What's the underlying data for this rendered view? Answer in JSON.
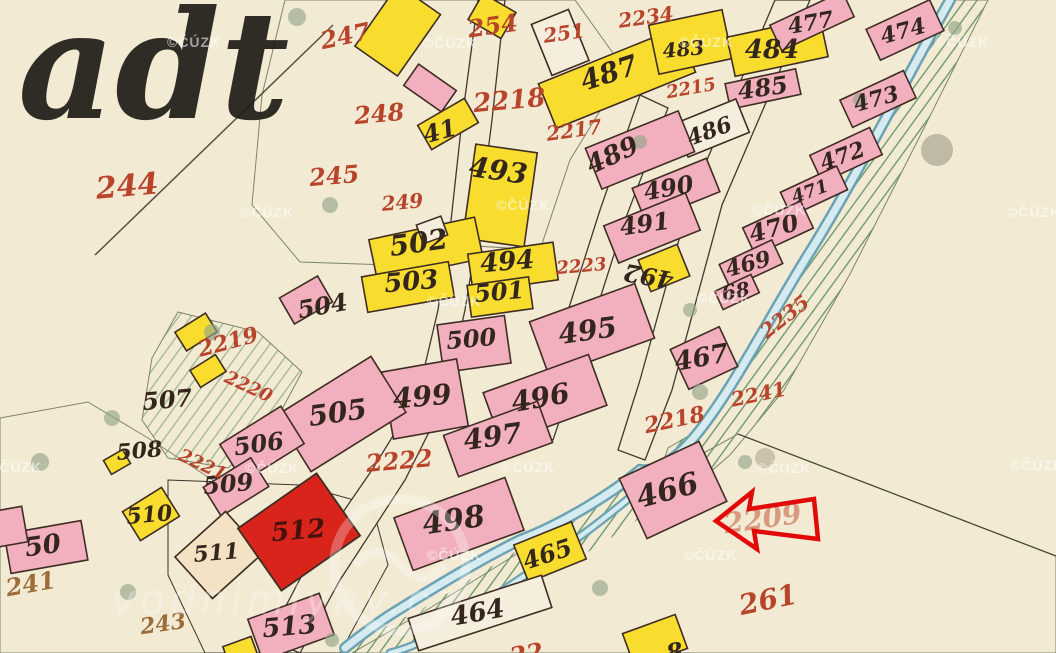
{
  "map": {
    "title_fragment": "adt",
    "copyright": "©ČÚZK",
    "watermark_logo": "vodnimlyny.cz",
    "arrow": {
      "color": "#e20909",
      "points_to_parcel": "466"
    },
    "colors": {
      "paper": "#f3ead3",
      "green_land": "#b3d5a8",
      "building_pink": "#f2afbe",
      "building_yellow": "#f8dd2f",
      "building_red": "#d9241b",
      "stream_blue": "#6ba3b5",
      "black_ink": "#33261c",
      "red_ink": "#b8442b"
    },
    "labels": [
      {
        "t": "41",
        "x": 442,
        "y": 139,
        "s": 24,
        "c": "ink",
        "r": -15
      },
      {
        "t": "483",
        "x": 684,
        "y": 56,
        "s": 20,
        "c": "ink",
        "r": -5
      },
      {
        "t": "484",
        "x": 772,
        "y": 58,
        "s": 26,
        "c": "ink",
        "r": 0
      },
      {
        "t": "485",
        "x": 764,
        "y": 96,
        "s": 24,
        "c": "ink",
        "r": -8
      },
      {
        "t": "477",
        "x": 812,
        "y": 30,
        "s": 22,
        "c": "ink",
        "r": -10
      },
      {
        "t": "474",
        "x": 905,
        "y": 38,
        "s": 22,
        "c": "ink",
        "r": -15
      },
      {
        "t": "473",
        "x": 878,
        "y": 106,
        "s": 22,
        "c": "ink",
        "r": -15
      },
      {
        "t": "472",
        "x": 845,
        "y": 163,
        "s": 22,
        "c": "ink",
        "r": -20
      },
      {
        "t": "471",
        "x": 812,
        "y": 197,
        "s": 18,
        "c": "ink",
        "r": -20
      },
      {
        "t": "470",
        "x": 776,
        "y": 236,
        "s": 24,
        "c": "ink",
        "r": -15
      },
      {
        "t": "469",
        "x": 750,
        "y": 271,
        "s": 22,
        "c": "ink",
        "r": -15
      },
      {
        "t": "68",
        "x": 737,
        "y": 298,
        "s": 20,
        "c": "ink",
        "r": -10
      },
      {
        "t": "467",
        "x": 703,
        "y": 366,
        "s": 26,
        "c": "ink",
        "r": -10
      },
      {
        "t": "466",
        "x": 670,
        "y": 500,
        "s": 30,
        "c": "ink",
        "r": -15
      },
      {
        "t": "486",
        "x": 712,
        "y": 138,
        "s": 22,
        "c": "ink",
        "r": -20
      },
      {
        "t": "487",
        "x": 612,
        "y": 82,
        "s": 28,
        "c": "ink",
        "r": -18
      },
      {
        "t": "489",
        "x": 616,
        "y": 163,
        "s": 26,
        "c": "ink",
        "r": -25
      },
      {
        "t": "490",
        "x": 670,
        "y": 196,
        "s": 24,
        "c": "ink",
        "r": -10
      },
      {
        "t": "491",
        "x": 646,
        "y": 232,
        "s": 24,
        "c": "ink",
        "r": -8
      },
      {
        "t": "492",
        "x": 650,
        "y": 268,
        "s": 24,
        "c": "ink",
        "r": 190
      },
      {
        "t": "493",
        "x": 497,
        "y": 180,
        "s": 28,
        "c": "ink",
        "r": 8
      },
      {
        "t": "494",
        "x": 508,
        "y": 270,
        "s": 26,
        "c": "ink",
        "r": -5
      },
      {
        "t": "501",
        "x": 500,
        "y": 300,
        "s": 24,
        "c": "ink",
        "r": -5
      },
      {
        "t": "502",
        "x": 420,
        "y": 252,
        "s": 28,
        "c": "ink",
        "r": -8
      },
      {
        "t": "503",
        "x": 412,
        "y": 290,
        "s": 26,
        "c": "ink",
        "r": -5
      },
      {
        "t": "500",
        "x": 472,
        "y": 347,
        "s": 24,
        "c": "ink",
        "r": -5
      },
      {
        "t": "495",
        "x": 589,
        "y": 340,
        "s": 28,
        "c": "ink",
        "r": -8
      },
      {
        "t": "496",
        "x": 542,
        "y": 407,
        "s": 28,
        "c": "ink",
        "r": -10
      },
      {
        "t": "497",
        "x": 494,
        "y": 446,
        "s": 28,
        "c": "ink",
        "r": -8
      },
      {
        "t": "498",
        "x": 455,
        "y": 530,
        "s": 30,
        "c": "ink",
        "r": -8
      },
      {
        "t": "499",
        "x": 423,
        "y": 406,
        "s": 28,
        "c": "ink",
        "r": -5
      },
      {
        "t": "504",
        "x": 324,
        "y": 314,
        "s": 24,
        "c": "ink",
        "r": -10
      },
      {
        "t": "505",
        "x": 339,
        "y": 422,
        "s": 28,
        "c": "ink",
        "r": -8
      },
      {
        "t": "506",
        "x": 260,
        "y": 452,
        "s": 24,
        "c": "ink",
        "r": -8
      },
      {
        "t": "507",
        "x": 168,
        "y": 408,
        "s": 24,
        "c": "ink",
        "r": -5
      },
      {
        "t": "508",
        "x": 140,
        "y": 458,
        "s": 22,
        "c": "ink",
        "r": -5
      },
      {
        "t": "509",
        "x": 229,
        "y": 492,
        "s": 24,
        "c": "ink",
        "r": -5
      },
      {
        "t": "510",
        "x": 150,
        "y": 522,
        "s": 22,
        "c": "ink",
        "r": -5
      },
      {
        "t": "511",
        "x": 217,
        "y": 560,
        "s": 22,
        "c": "ink",
        "r": -5
      },
      {
        "t": "512",
        "x": 299,
        "y": 539,
        "s": 26,
        "c": "dark",
        "r": -5
      },
      {
        "t": "513",
        "x": 290,
        "y": 635,
        "s": 26,
        "c": "ink",
        "r": -5
      },
      {
        "t": "50",
        "x": 44,
        "y": 554,
        "s": 26,
        "c": "ink",
        "r": -8
      },
      {
        "t": "464",
        "x": 479,
        "y": 621,
        "s": 26,
        "c": "ink",
        "r": -10
      },
      {
        "t": "465",
        "x": 550,
        "y": 562,
        "s": 24,
        "c": "ink",
        "r": -18
      },
      {
        "t": "8",
        "x": 676,
        "y": 660,
        "s": 24,
        "c": "ink",
        "r": -10
      },
      {
        "t": "244",
        "x": 128,
        "y": 196,
        "s": 30,
        "c": "red",
        "r": -5
      },
      {
        "t": "247",
        "x": 347,
        "y": 44,
        "s": 24,
        "c": "red",
        "r": -12
      },
      {
        "t": "248",
        "x": 380,
        "y": 122,
        "s": 24,
        "c": "red",
        "r": -5
      },
      {
        "t": "245",
        "x": 335,
        "y": 184,
        "s": 24,
        "c": "red",
        "r": -5
      },
      {
        "t": "249",
        "x": 403,
        "y": 209,
        "s": 20,
        "c": "red",
        "r": -5
      },
      {
        "t": "254",
        "x": 494,
        "y": 34,
        "s": 24,
        "c": "red",
        "r": -8
      },
      {
        "t": "251",
        "x": 565,
        "y": 40,
        "s": 20,
        "c": "red",
        "r": -8
      },
      {
        "t": "2234",
        "x": 647,
        "y": 24,
        "s": 20,
        "c": "red",
        "r": -8
      },
      {
        "t": "2215",
        "x": 692,
        "y": 94,
        "s": 18,
        "c": "red",
        "r": -10
      },
      {
        "t": "2218",
        "x": 510,
        "y": 109,
        "s": 26,
        "c": "red",
        "r": -5
      },
      {
        "t": "2217",
        "x": 575,
        "y": 137,
        "s": 20,
        "c": "red",
        "r": -8
      },
      {
        "t": "2223",
        "x": 582,
        "y": 272,
        "s": 18,
        "c": "red",
        "r": -5
      },
      {
        "t": "2219",
        "x": 230,
        "y": 349,
        "s": 22,
        "c": "red",
        "r": -15
      },
      {
        "t": "2220",
        "x": 246,
        "y": 392,
        "s": 18,
        "c": "red",
        "r": 25
      },
      {
        "t": "2221",
        "x": 200,
        "y": 470,
        "s": 18,
        "c": "red",
        "r": 25
      },
      {
        "t": "2222",
        "x": 400,
        "y": 469,
        "s": 24,
        "c": "red",
        "r": -5
      },
      {
        "t": "2235",
        "x": 789,
        "y": 322,
        "s": 20,
        "c": "red",
        "r": -38
      },
      {
        "t": "2241",
        "x": 760,
        "y": 401,
        "s": 20,
        "c": "red",
        "r": -12
      },
      {
        "t": "2218",
        "x": 676,
        "y": 427,
        "s": 22,
        "c": "red",
        "r": -12
      },
      {
        "t": "2209",
        "x": 764,
        "y": 528,
        "s": 28,
        "c": "faded",
        "r": -8
      },
      {
        "t": "261",
        "x": 770,
        "y": 609,
        "s": 28,
        "c": "red",
        "r": -12
      },
      {
        "t": "241",
        "x": 32,
        "y": 592,
        "s": 24,
        "c": "brown",
        "r": -10
      },
      {
        "t": "243",
        "x": 164,
        "y": 631,
        "s": 22,
        "c": "brown",
        "r": -8
      },
      {
        "t": "22",
        "x": 528,
        "y": 662,
        "s": 24,
        "c": "red",
        "r": -10
      }
    ],
    "watermarks": [
      [
        167,
        47
      ],
      [
        423,
        48
      ],
      [
        679,
        47
      ],
      [
        935,
        47
      ],
      [
        240,
        217
      ],
      [
        496,
        210
      ],
      [
        752,
        215
      ],
      [
        1007,
        217
      ],
      [
        427,
        306
      ],
      [
        697,
        303
      ],
      [
        -12,
        472
      ],
      [
        245,
        473
      ],
      [
        501,
        472
      ],
      [
        757,
        473
      ],
      [
        1010,
        470
      ],
      [
        427,
        560
      ],
      [
        683,
        560
      ]
    ]
  }
}
